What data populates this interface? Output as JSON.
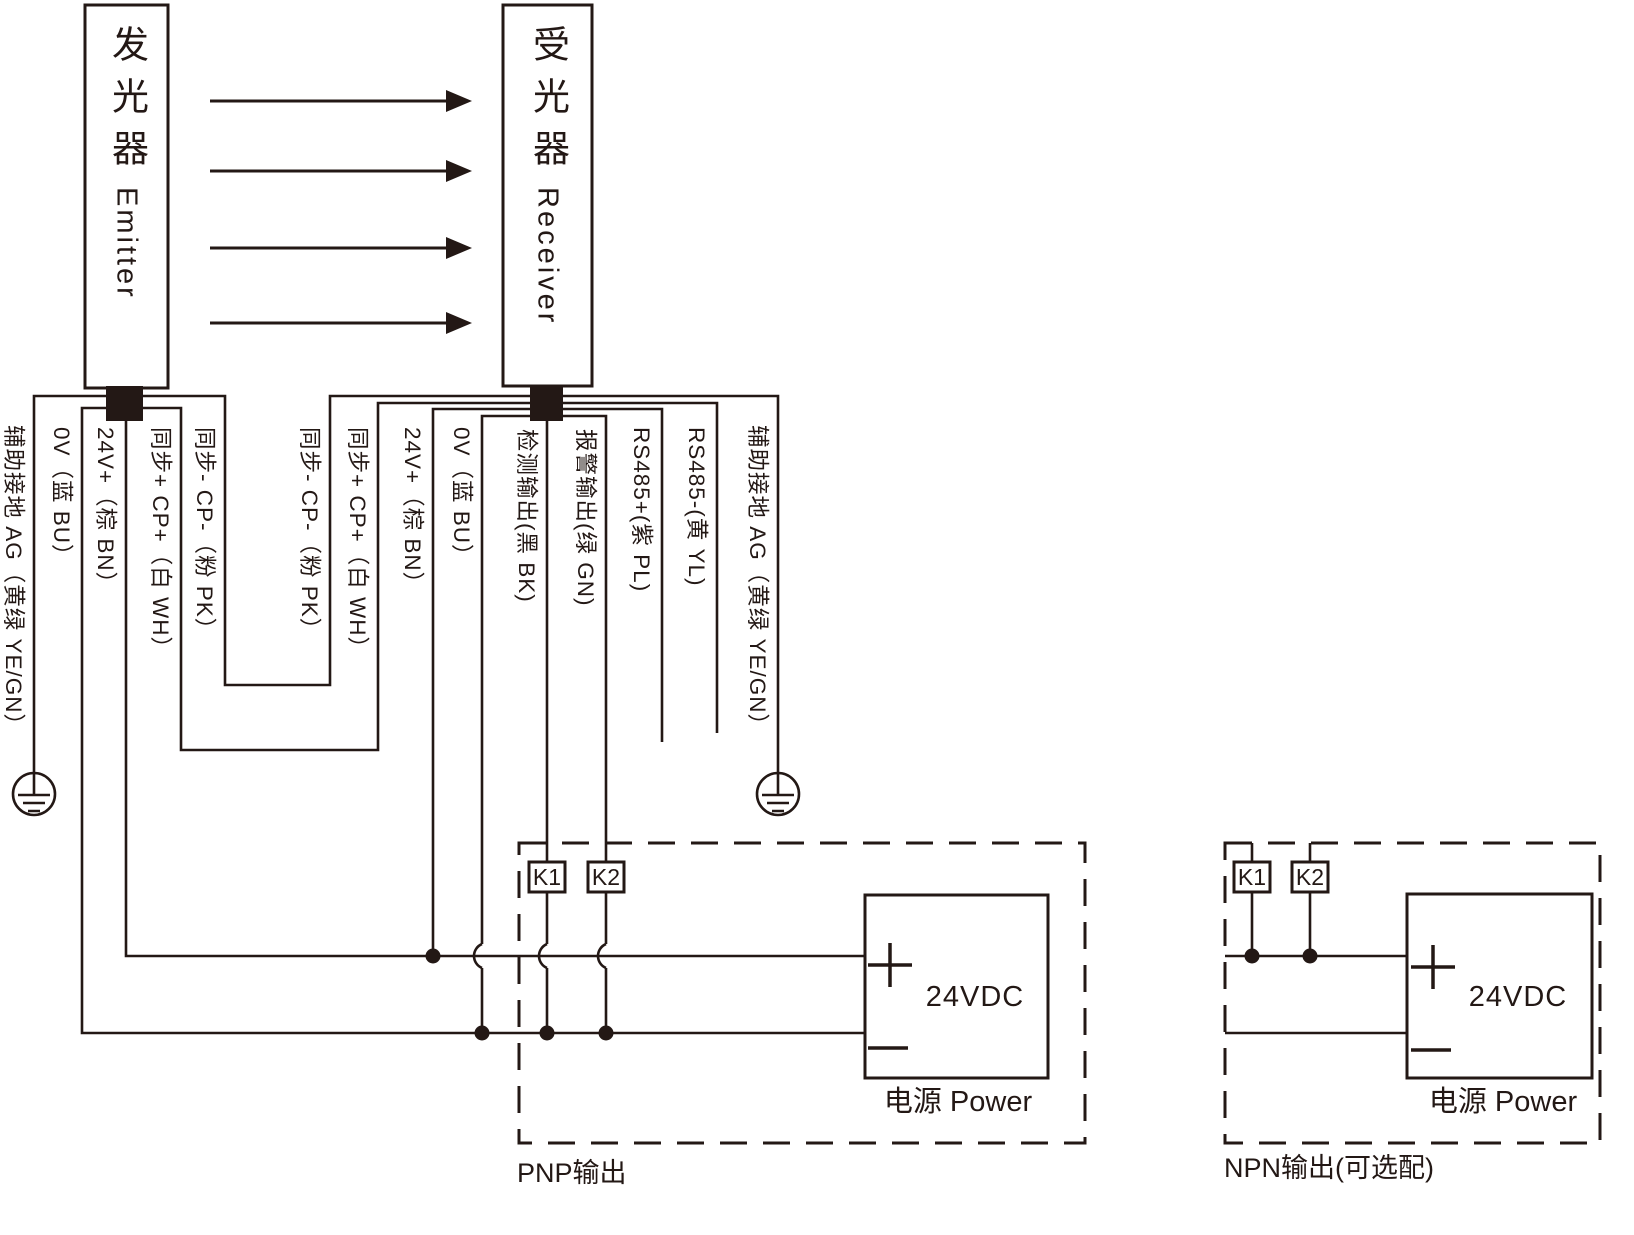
{
  "colors": {
    "ink": "#231815",
    "background": "#ffffff"
  },
  "devices": {
    "emitter": {
      "name_cjk": "发光器",
      "name_latin": "Emitter"
    },
    "receiver": {
      "name_cjk": "受光器",
      "name_latin": "Receiver"
    }
  },
  "emitter_wires": [
    {
      "label": "辅助接地 AG（黄绿 YE/GN）"
    },
    {
      "label": "0V（蓝 BU）"
    },
    {
      "label": "24V+（棕 BN）"
    },
    {
      "label": "同步+ CP+（白 WH）"
    },
    {
      "label": "同步- CP-（粉 PK）"
    }
  ],
  "receiver_wires": [
    {
      "label": "同步- CP-（粉 PK）"
    },
    {
      "label": "同步+ CP+（白 WH）"
    },
    {
      "label": "24V+（棕 BN）"
    },
    {
      "label": "0V（蓝 BU）"
    },
    {
      "label": "检测输出(黑 BK)"
    },
    {
      "label": "报警输出(绿 GN)"
    },
    {
      "label": "RS485+(紫 PL)"
    },
    {
      "label": "RS485-(黄 YL)"
    },
    {
      "label": "辅助接地 AG（黄绿 YE/GN）"
    }
  ],
  "pnp_section": {
    "relay1": "K1",
    "relay2": "K2",
    "supply": "24VDC",
    "supply_caption": "电源 Power",
    "caption": "PNP输出"
  },
  "npn_section": {
    "relay1": "K1",
    "relay2": "K2",
    "supply": "24VDC",
    "supply_caption": "电源 Power",
    "caption": "NPN输出(可选配)"
  }
}
